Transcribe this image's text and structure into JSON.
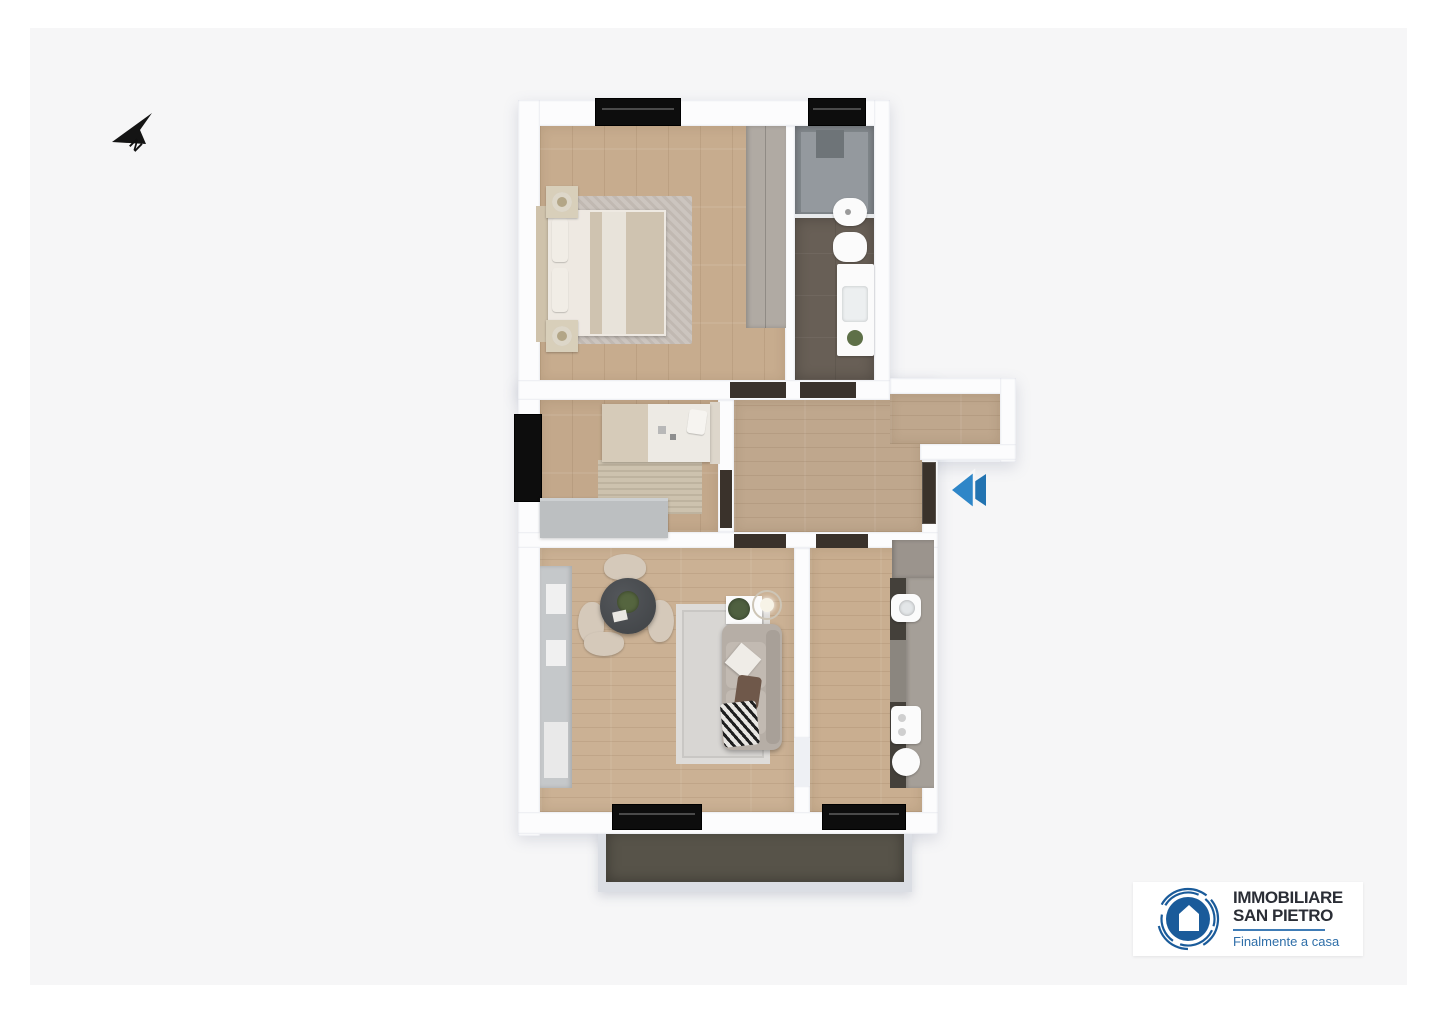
{
  "page": {
    "background": "#ffffff",
    "canvas_color": "#f6f6f7"
  },
  "compass": {
    "label": "N",
    "icon": "north-arrow-icon",
    "color": "#141414"
  },
  "entrance_marker": {
    "icon": "double-chevron-left-icon",
    "color": "#2e86c8"
  },
  "brand": {
    "line1": "IMMOBILIARE",
    "line2": "SAN PIETRO",
    "tagline": "Finalmente a casa",
    "icon": "house-in-circle-icon",
    "colors": {
      "circle_blue": "#1a5b9a",
      "name_dark": "#2b2e36",
      "tagline_blue": "#2e6ea8",
      "divider_blue": "#3f7cb6"
    }
  },
  "floorplan": {
    "kind": "apartment 3D top-down floor plan",
    "rooms": [
      {
        "name": "bedroom",
        "features": [
          "double-bed",
          "two-nightstands",
          "rug",
          "wardrobe",
          "window"
        ]
      },
      {
        "name": "bathroom",
        "features": [
          "shower",
          "bidet",
          "toilet",
          "vanity-sink",
          "window"
        ]
      },
      {
        "name": "second-bedroom",
        "features": [
          "single-bed",
          "rug",
          "sideboard",
          "window"
        ]
      },
      {
        "name": "hallway",
        "features": [
          "entrance-door",
          "niche"
        ]
      },
      {
        "name": "living-dining-room",
        "features": [
          "round-table",
          "four-chairs",
          "sofa",
          "rug",
          "floor-lamp",
          "side-table",
          "bookcase",
          "balcony-door"
        ]
      },
      {
        "name": "kitchen",
        "features": [
          "counter",
          "sink",
          "cooktop",
          "tall-cabinet",
          "balcony-door"
        ]
      },
      {
        "name": "balcony",
        "features": []
      }
    ],
    "colors": {
      "wood_floor": "#c7ac8e",
      "bath_floor": "#685f56",
      "balcony_floor": "#575349",
      "walls": "#fcfcfd",
      "windows": "#0d0d0d",
      "doors": "#3a322b"
    }
  }
}
